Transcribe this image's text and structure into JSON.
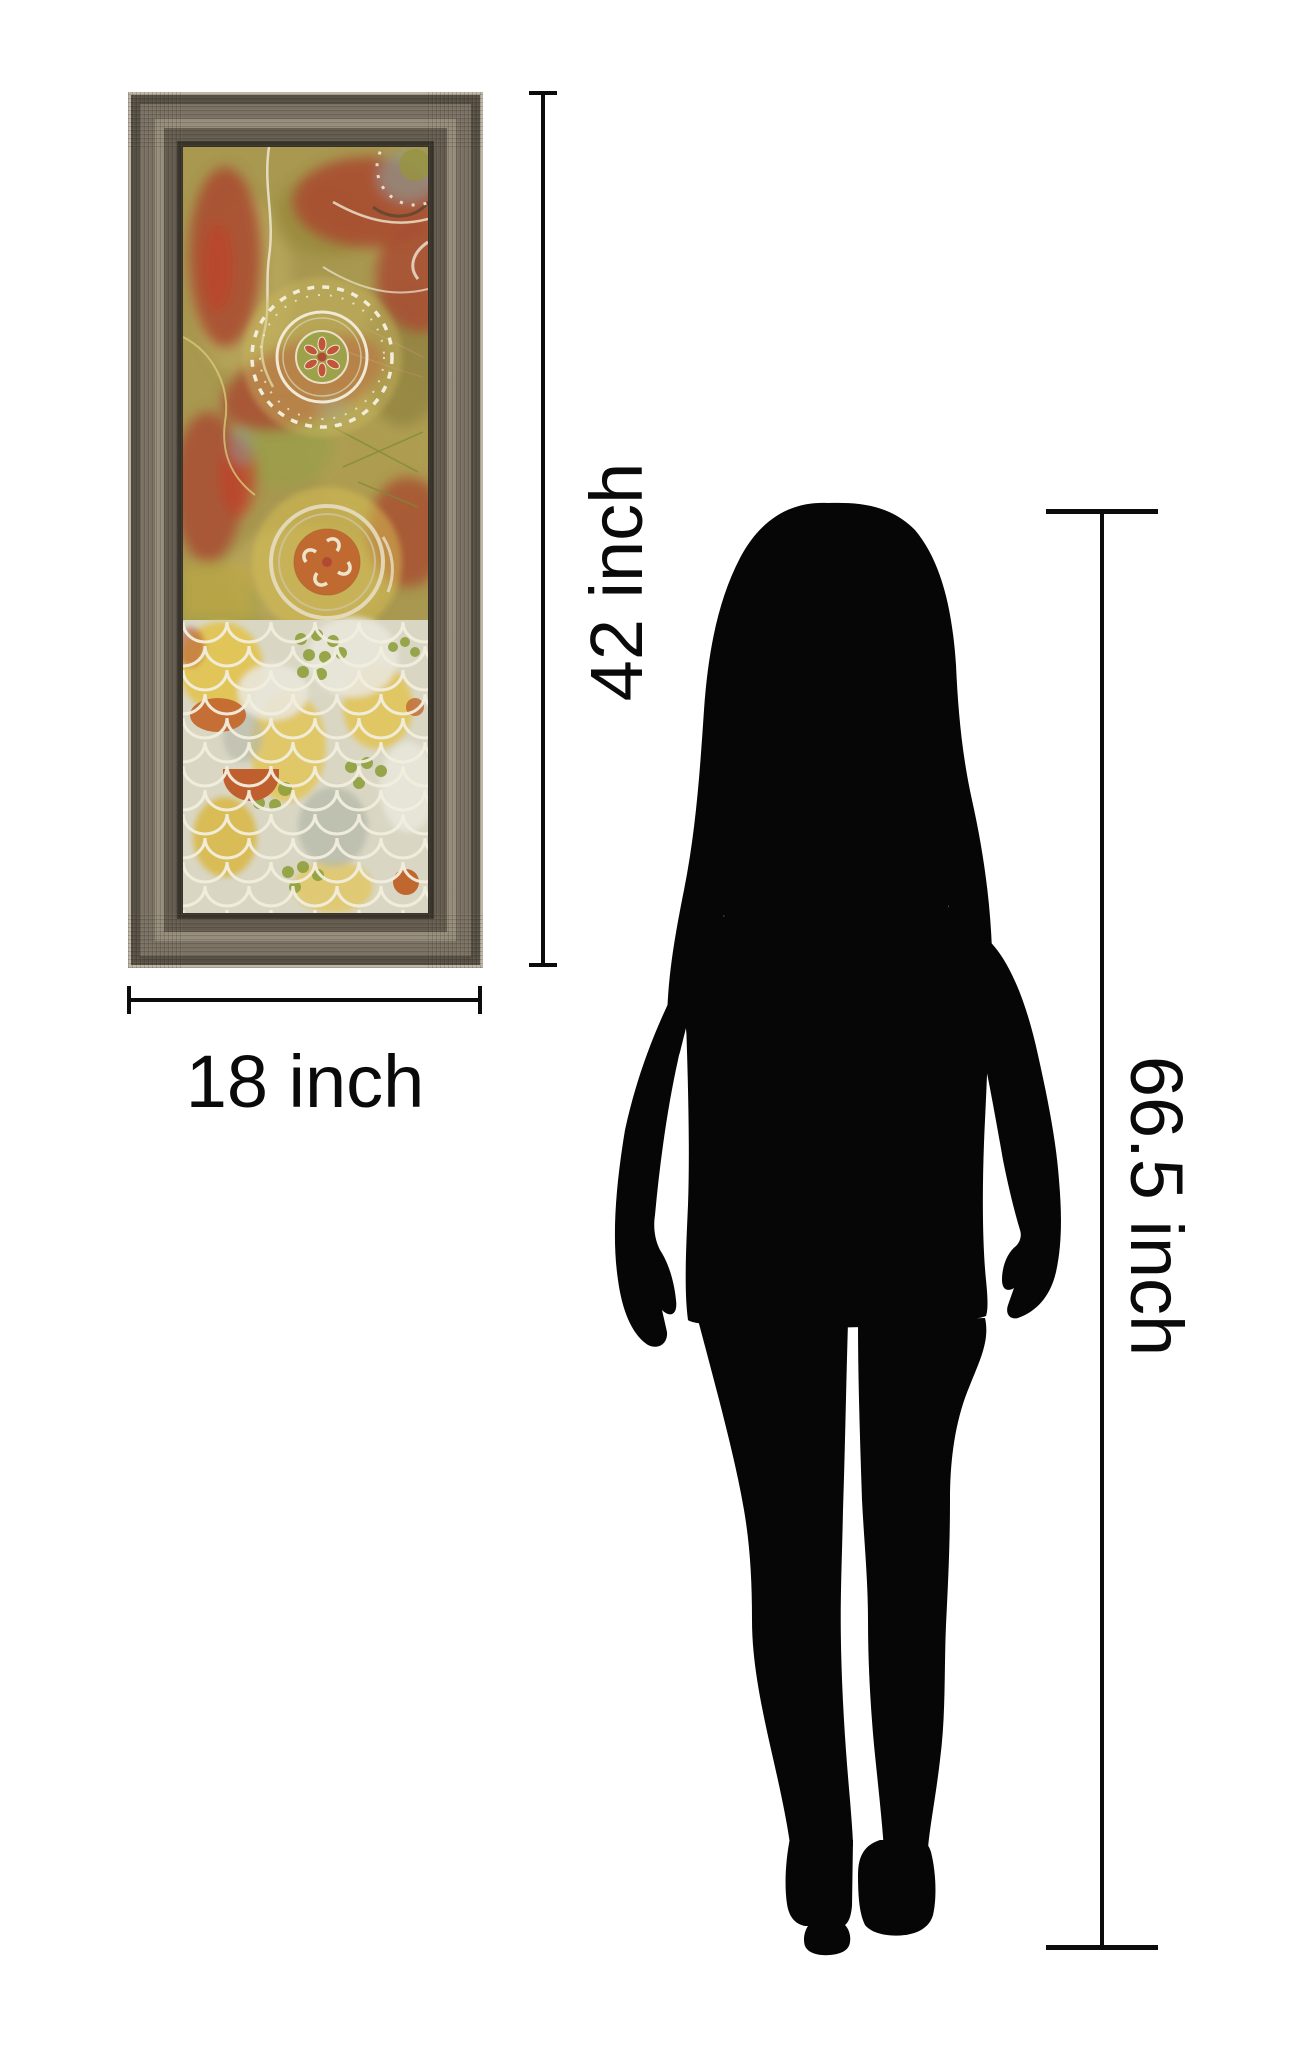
{
  "page": {
    "background": "#ffffff"
  },
  "labels": {
    "art_height": "42 inch",
    "art_width": "18 inch",
    "person_height": "66.5 inch"
  },
  "colors": {
    "dimension_line": "#0c0c0c",
    "label_text": "#0a0a0a",
    "silhouette": "#060606",
    "frame_outer_highlight": "#bdb5a6",
    "frame_dark": "#554e42",
    "frame_mid": "#7a7163",
    "frame_light": "#968c7b",
    "frame_deep": "#645c4e",
    "frame_lip": "#3a352c",
    "art_background": "#a89850",
    "art_red": "#a84e31",
    "art_cream": "#f0ebd8",
    "art_orange": "#c06a32",
    "art_yellow": "#e2c453",
    "art_green": "#8fa03c",
    "scale_bg": "#d9d6c4"
  }
}
